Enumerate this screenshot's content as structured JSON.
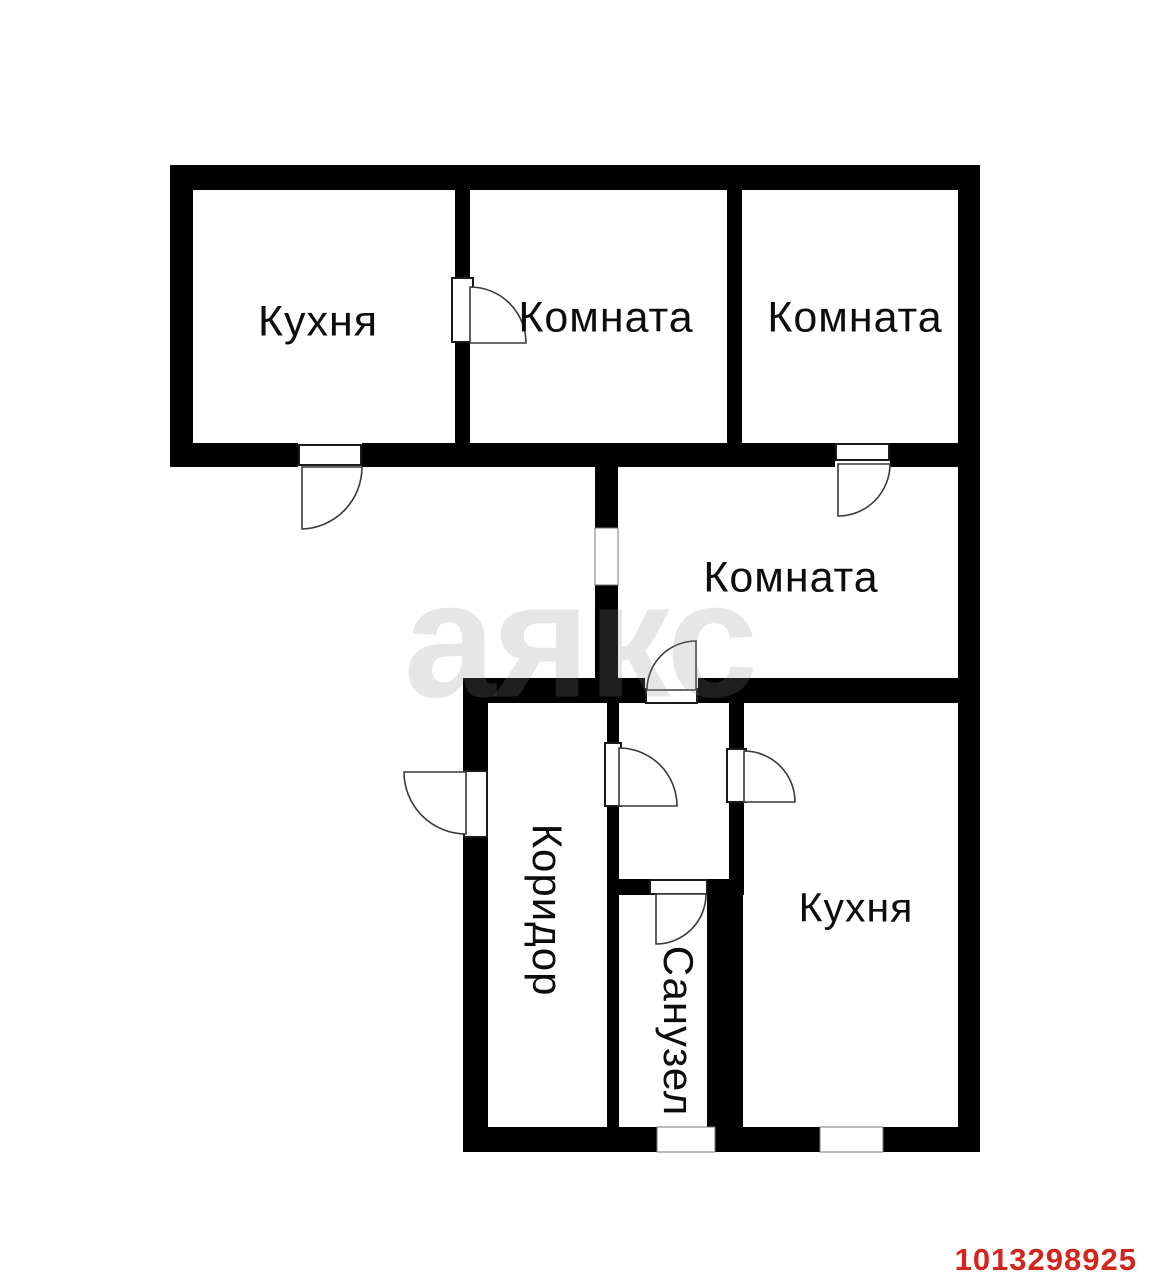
{
  "rooms": {
    "kitchen_top": "Кухня",
    "room_top_middle": "Комната",
    "room_top_right": "Комната",
    "room_middle": "Комната",
    "kitchen_bottom": "Кухня",
    "corridor": "Коридор",
    "bathroom": "Санузел"
  },
  "watermark_text": "аякс",
  "listing_id": "1013298925",
  "colors": {
    "walls": "#000000",
    "background": "#ffffff",
    "listing_id": "#d3251d",
    "watermark": "rgba(140,140,140,0.22)"
  }
}
